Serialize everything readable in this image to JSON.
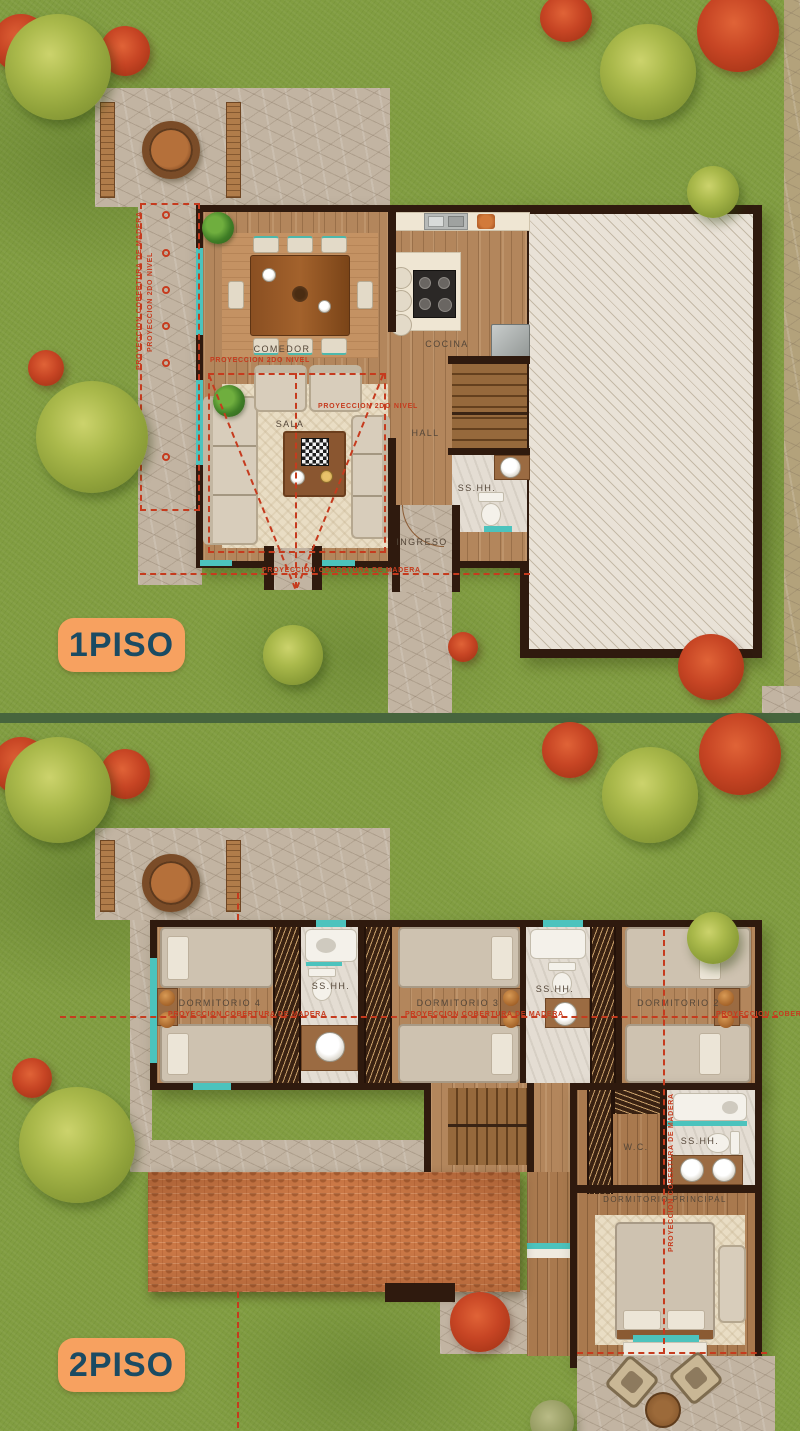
{
  "floor1": {
    "badge": "1PISO",
    "rooms": {
      "comedor": "COMEDOR",
      "cocina": "COCINA",
      "sala": "SALA",
      "hall": "HALL",
      "sshh": "SS.HH.",
      "ingreso": "INGRESO"
    },
    "annotations": {
      "cobertura_madera_left": "PROYECCION COBERTURA DE MADERA",
      "segundo_nivel_left": "PROYECCION 2DO NIVEL",
      "segundo_nivel_a": "PROYECCION 2DO NIVEL",
      "segundo_nivel_b": "PROYECCION 2DO NIVEL",
      "cobertura_madera_bottom": "PROYECCION COBERTURA DE MADERA"
    }
  },
  "floor2": {
    "badge": "2PISO",
    "rooms": {
      "dormitorio4": "DORMITORIO 4",
      "sshh_1": "SS.HH.",
      "dormitorio3": "DORMITORIO 3",
      "sshh_2": "SS.HH.",
      "dormitorio2": "DORMITORIO 2",
      "wc": "W.C.",
      "sshh_3": "SS.HH.",
      "dormitorio_principal": "DORMITORIO PRINCIPAL"
    },
    "annotations": {
      "cobertura_madera_line_left": "PROYECCION COBERTURA DE MADERA",
      "cobertura_madera_line_mid": "PROYECCION COBERTURA DE MADERA",
      "cobertura_madera_line_right": "PROYECCION COBERTURA DE MADERA",
      "cobertura_madera_vertical": "PROYECCION COBERTURA DE MADERA"
    }
  },
  "colors": {
    "badge_background": "#f7a160",
    "badge_text": "#1b4b63",
    "annotation_red": "#c63b1e",
    "window_teal": "#4cc3bd",
    "roof_tile_orange": "#cb7846",
    "grass_green": "#819d41",
    "wall_dark_brown": "#2f1a0e"
  }
}
